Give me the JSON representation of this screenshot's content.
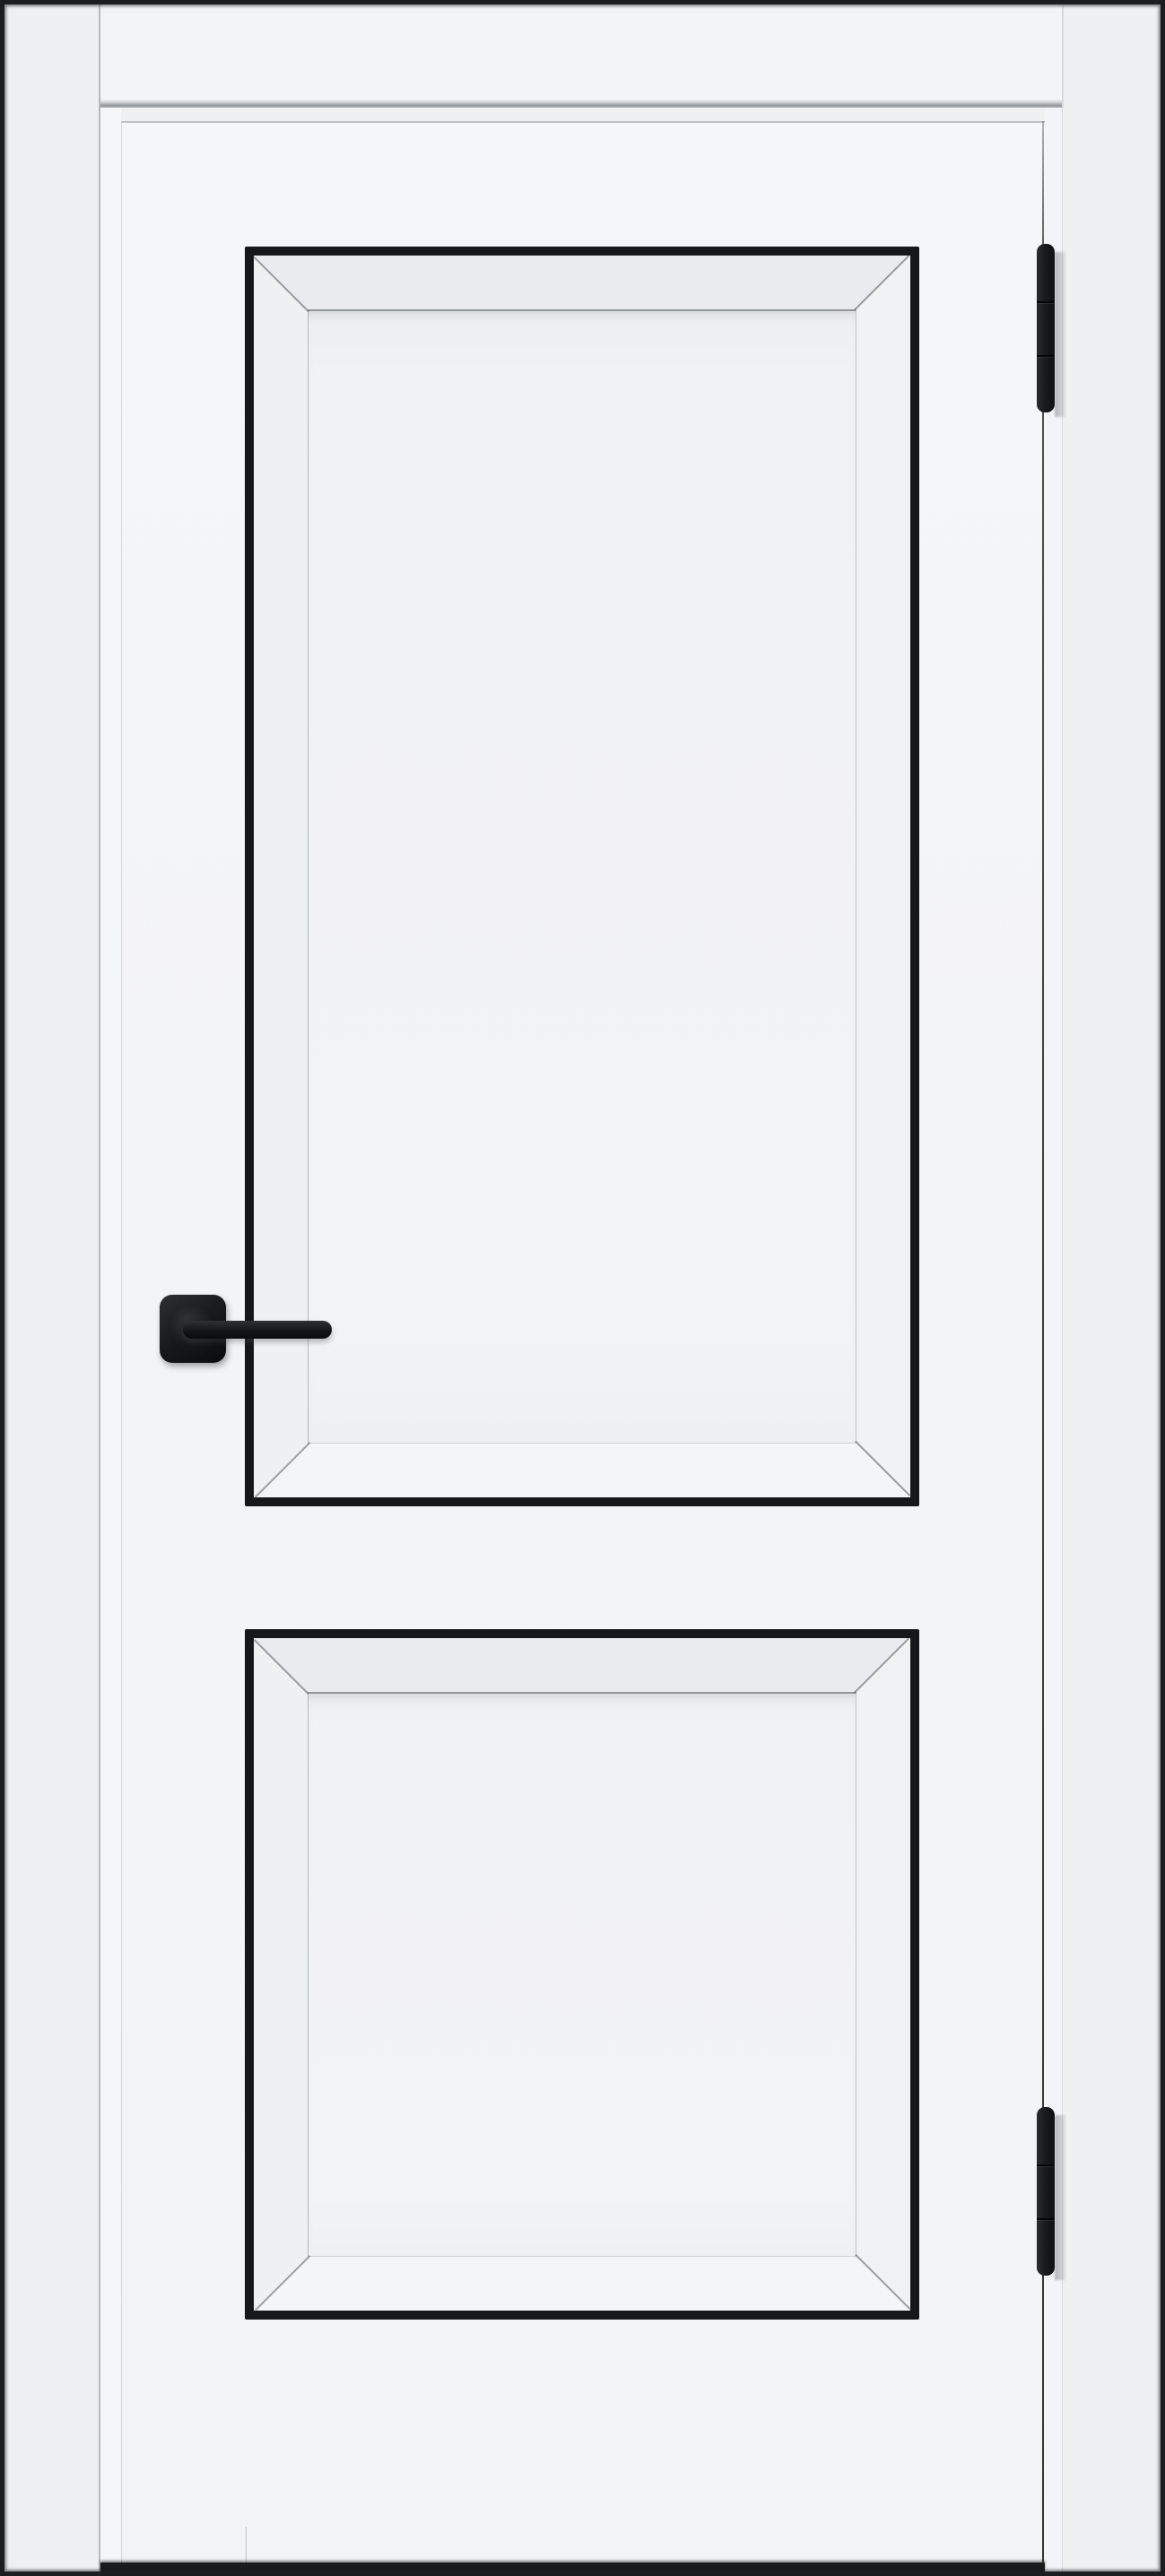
{
  "scene": {
    "description": "Product photo of a white interior door with two recessed panels outlined in thin black trim, a matte black square-rosette lever handle on the left stile, and two black three-knuckle hinges on the right edge, set in a white door frame against a white wall with a dark gap shadow under the door",
    "object": "interior-door",
    "door_color_name": "white",
    "hardware_color_name": "matte-black",
    "panel_count": 2,
    "hinge_count": 2,
    "hinge_knuckles_per_hinge": 3
  },
  "colors": {
    "wall": "#eff0f2",
    "frame": "#f3f4f6",
    "lintel-shadow": "#96999c",
    "door": "#f4f5f7",
    "trim": "#151719",
    "bevel-top": "#e9ebee",
    "bevel-side-left": "#eef0f2",
    "bevel-side-right": "#f1f2f4",
    "bevel-bottom": "#f4f5f7",
    "field": "#f2f3f5",
    "field-line": "#94979a",
    "handle": "#141517",
    "hinge": "#1a1b1d",
    "edge-line": "#303234",
    "floor-gap": "#1a1b1c",
    "photo-border": "#1c1d1f"
  },
  "components": {
    "frame_header": "door-frame header casing",
    "left_jamb": "left frame jamb reveal",
    "right_jamb": "right frame jamb reveal",
    "door_leaf": "hinged door leaf",
    "upper_panel": "large upper recessed panel with black trim",
    "lower_panel": "square lower recessed panel with black trim",
    "handle": "black lever handle on square rosette",
    "top_hinge": "black barrel hinge, upper",
    "bottom_hinge": "black barrel hinge, lower",
    "floor_shadow": "dark gap below door leaf"
  }
}
